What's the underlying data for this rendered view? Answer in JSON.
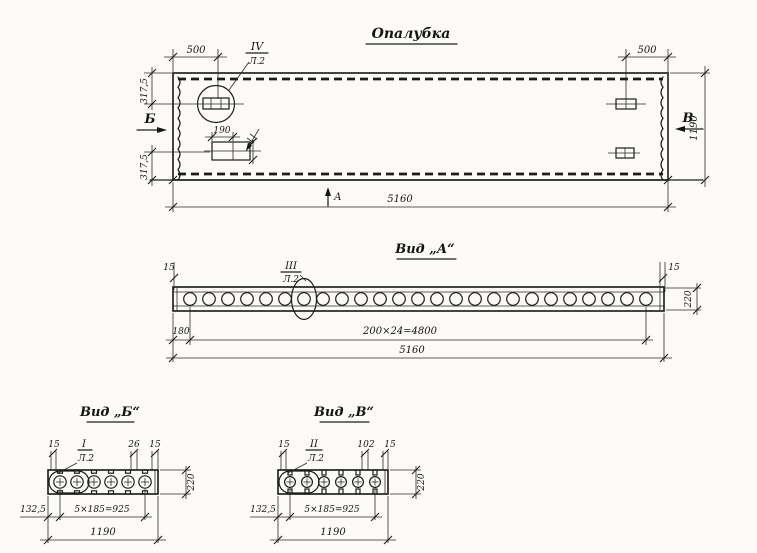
{
  "style": {
    "ink_color": "#1c1c1c",
    "paper_color": "#fcfbf8"
  },
  "drawing": {
    "top_view": {
      "title": "Опалубка",
      "callout": {
        "num": "IV",
        "sheet": "Л.2"
      },
      "dims": {
        "d500_left": "500",
        "d500_right": "500",
        "d317_upper": "317,5",
        "d317_lower": "317,5",
        "d190": "190",
        "d1190": "1190",
        "d5160": "5160"
      },
      "sections": {
        "b": "Б",
        "v": "В",
        "a": "А"
      }
    },
    "view_a": {
      "title": "Вид „А“",
      "callout": {
        "num": "III",
        "sheet": "Л.2"
      },
      "holes": 25,
      "dims": {
        "d15_left": "15",
        "d15_right": "15",
        "d220": "220",
        "d180": "180",
        "d4800": "200×24=4800",
        "d5160": "5160"
      }
    },
    "view_b": {
      "title": "Вид „Б“",
      "callout": {
        "num": "I",
        "sheet": "Л.2"
      },
      "holes": 6,
      "dims": {
        "d15_left": "15",
        "d26": "26",
        "d15_right": "15",
        "d220": "220",
        "d132": "132,5",
        "d925": "5×185=925",
        "d1190": "1190"
      }
    },
    "view_v": {
      "title": "Вид „В“",
      "callout": {
        "num": "II",
        "sheet": "Л.2"
      },
      "holes": 6,
      "dims": {
        "d15_left": "15",
        "d102": "102",
        "d15_right": "15",
        "d220": "220",
        "d132": "132,5",
        "d925": "5×185=925",
        "d1190": "1190"
      }
    }
  }
}
